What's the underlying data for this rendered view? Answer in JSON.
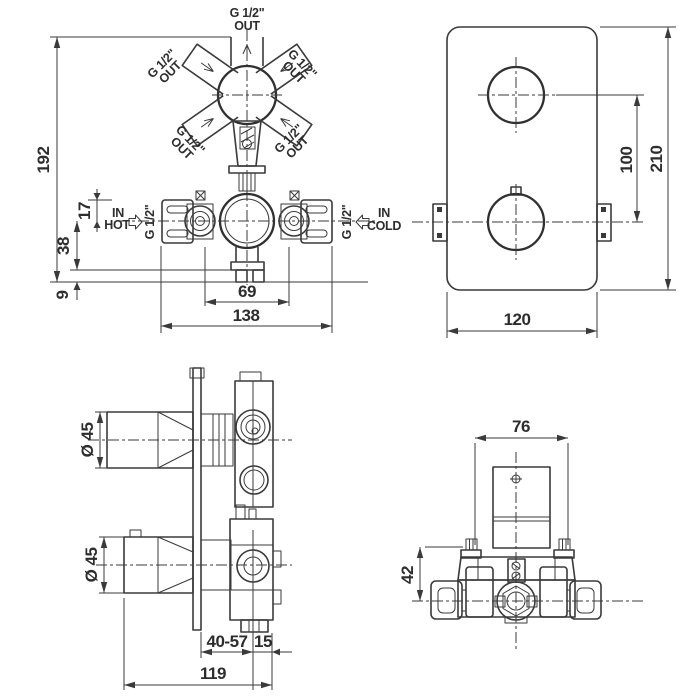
{
  "colors": {
    "line": "#3a3a3a",
    "background": "#ffffff"
  },
  "front_view": {
    "outlet_labels": [
      {
        "thread": "G 1/2\"",
        "flow": "OUT"
      },
      {
        "thread": "G 1/2\"",
        "flow": "OUT"
      },
      {
        "thread": "G 1/2\"",
        "flow": "OUT"
      },
      {
        "thread": "G 1/2\"",
        "flow": "OUT"
      },
      {
        "thread": "G 1/2\"",
        "flow": "OUT"
      }
    ],
    "inlets": {
      "hot": {
        "word_in": "IN",
        "word_temp": "HOT",
        "thread": "G 1/2\""
      },
      "cold": {
        "word_in": "IN",
        "word_temp": "COLD",
        "thread": "G 1/2\""
      }
    },
    "dims": {
      "total_height": "192",
      "bracket_top_to_axis": "17",
      "axis_to_base": "38",
      "base_feet": "9",
      "body_width": "69",
      "bracket_span": "138"
    }
  },
  "faceplate_view": {
    "dims": {
      "handle_spacing": "100",
      "plate_height": "210",
      "plate_width": "120"
    }
  },
  "side_view": {
    "dims": {
      "upper_handle_diameter": "Ø 45",
      "lower_handle_diameter": "Ø 45",
      "adjust_depth_range": "40-57",
      "trim_depth": "15",
      "total_depth": "119"
    }
  },
  "top_view": {
    "dims": {
      "body_width": "76",
      "axis_offset": "42"
    }
  }
}
